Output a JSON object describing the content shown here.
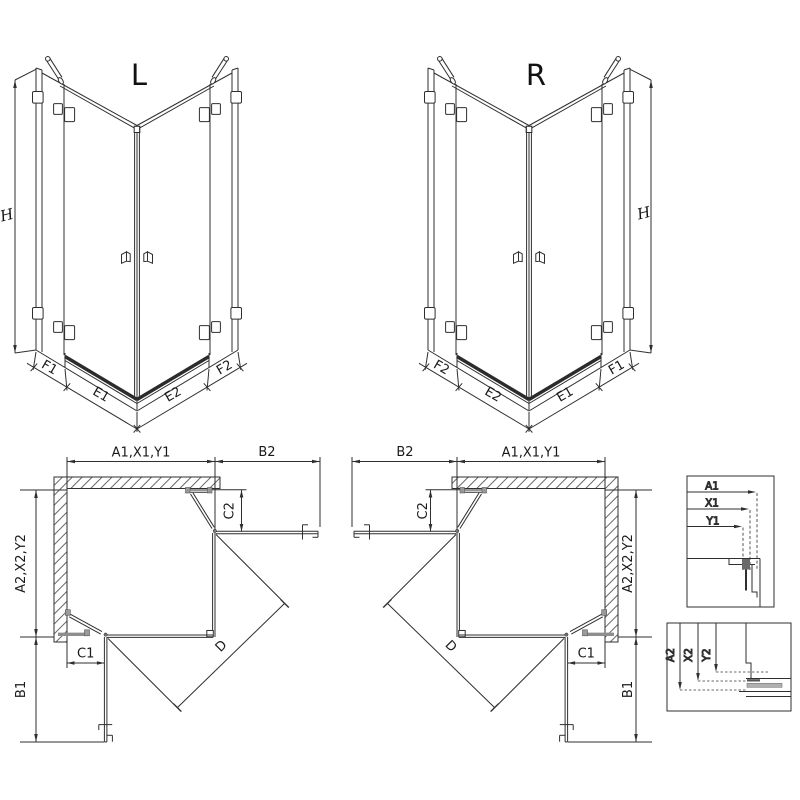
{
  "page": {
    "background": "#ffffff",
    "line_color": "#2f2f2f",
    "hatch_color": "#666666",
    "tray_color": "#2b2b2b",
    "profile_gray": "#8e8e8e"
  },
  "views": {
    "front_left": {
      "variant_label": "L",
      "height_dim": "H",
      "bottom_dims": [
        "F1",
        "E1",
        "E2",
        "F2"
      ]
    },
    "front_right": {
      "variant_label": "R",
      "height_dim": "H",
      "bottom_dims": [
        "F2",
        "E2",
        "E1",
        "F1"
      ]
    },
    "plan_left": {
      "width_dim": "A1,X1,Y1",
      "side_door_dim": "B2",
      "depth_dim": "A2,X2,Y2",
      "front_door_dim": "B1",
      "top_door_width_dim": "C2",
      "bottom_door_width_dim": "C1",
      "diagonal_dim": "D"
    },
    "plan_right": {
      "width_dim": "A1,X1,Y1",
      "side_door_dim": "B2",
      "depth_dim": "A2,X2,Y2",
      "front_door_dim": "B1",
      "top_door_width_dim": "C2",
      "bottom_door_width_dim": "C1",
      "diagonal_dim": "D"
    },
    "detail_width_profile": {
      "dims": [
        "A1",
        "X1",
        "Y1"
      ]
    },
    "detail_depth_profile": {
      "dims": [
        "A2",
        "X2",
        "Y2"
      ]
    }
  }
}
